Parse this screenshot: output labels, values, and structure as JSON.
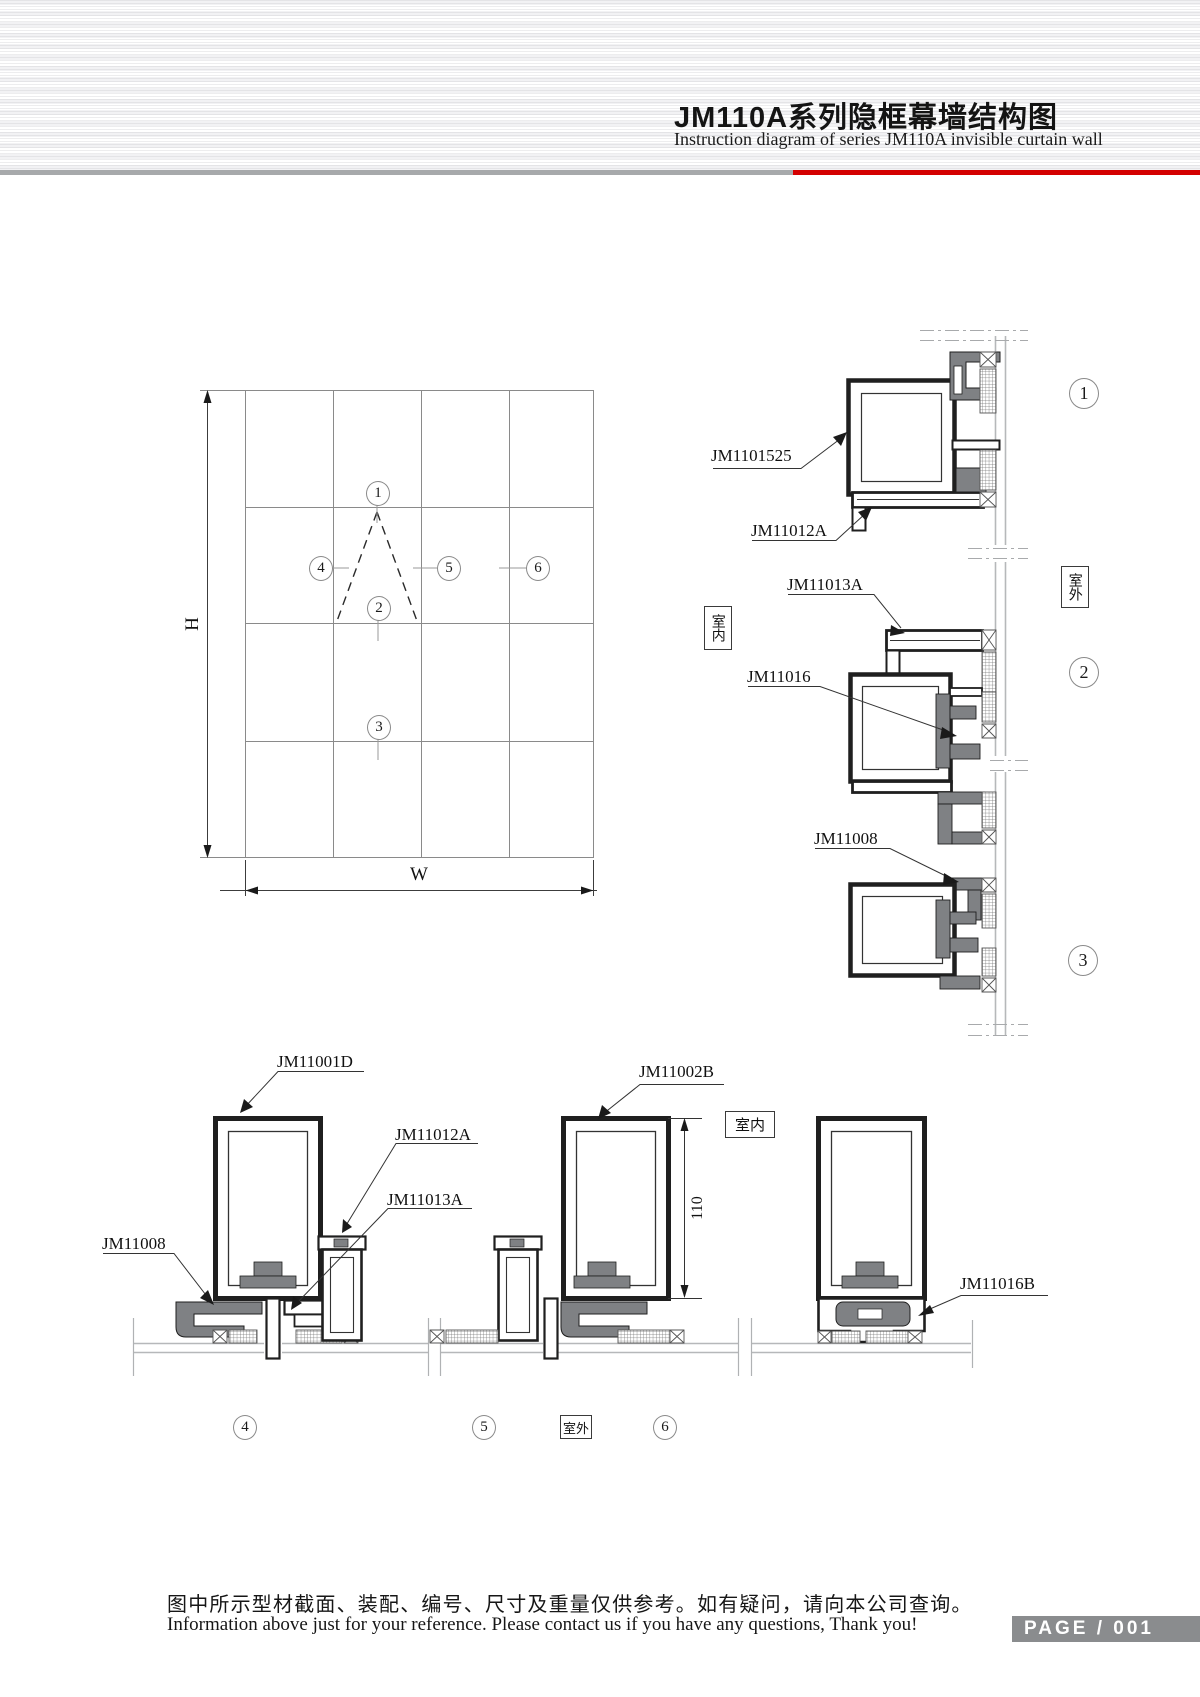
{
  "header": {
    "title_zh": "JM110A系列隐框幕墙结构图",
    "title_en": "Instruction diagram of series JM110A invisible curtain wall"
  },
  "elevation": {
    "h": "H",
    "w": "W"
  },
  "callouts": {
    "c1": "1",
    "c2": "2",
    "c3": "3",
    "c4": "4",
    "c5": "5",
    "c6": "6"
  },
  "room": {
    "indoor": "室内",
    "outdoor": "室外"
  },
  "parts": {
    "p1101525": "JM1101525",
    "p11012a": "JM11012A",
    "p11013a": "JM11013A",
    "p11016": "JM11016",
    "p11008": "JM11008",
    "p11001d": "JM11001D",
    "p11002b": "JM11002B",
    "p11012a_b": "JM11012A",
    "p11013a_b": "JM11013A",
    "p11008_b": "JM11008",
    "p11016b": "JM11016B"
  },
  "dimensions": {
    "mullion_depth": "110"
  },
  "footer": {
    "note_zh": "图中所示型材截面、装配、编号、尺寸及重量仅供参考。如有疑问，请向本公司查询。",
    "note_en": "Information above just for your reference. Please contact us if you have any questions, Thank you!",
    "page_label": "PAGE / 001"
  }
}
